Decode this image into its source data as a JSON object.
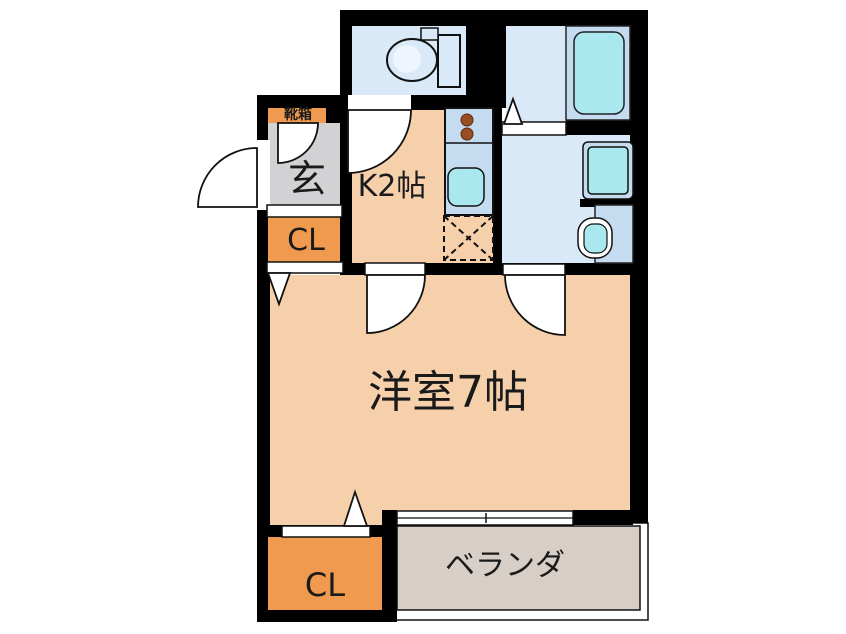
{
  "floor_plan": {
    "labels": {
      "shoe_box": "靴箱",
      "entrance": "玄",
      "kitchen": "K2帖",
      "closet_upper": "CL",
      "main_room": "洋室7帖",
      "closet_lower": "CL",
      "veranda": "ベランダ"
    },
    "colors": {
      "wall": "#000000",
      "room_floor": "#f6d0aa",
      "closet": "#ef9a4e",
      "entrance_floor": "#d2d2d4",
      "wet_room_floor": "#d9e9f8",
      "fixture": "#c5dbf0",
      "water": "#a8e8ee",
      "burner": "#9a4d20",
      "veranda_floor": "#d7cfc7",
      "door_white": "#ffffff",
      "text": "#1a1a1a"
    }
  }
}
